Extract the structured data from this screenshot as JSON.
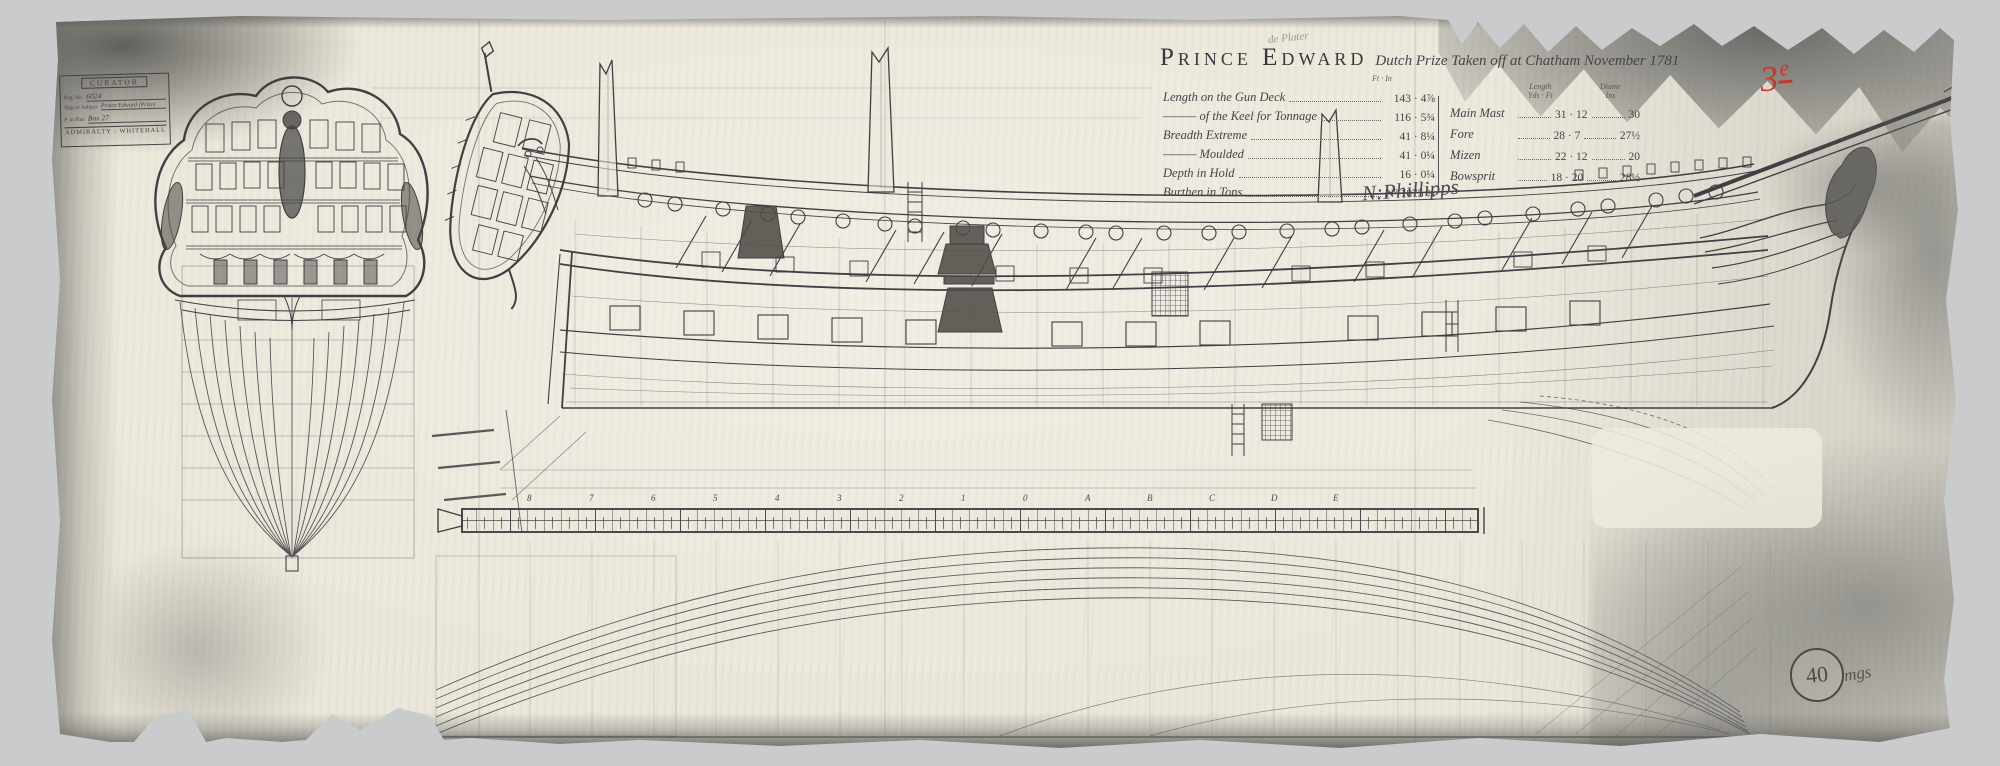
{
  "document": {
    "ship_name": "Prince Edward",
    "subtitle": "Dutch Prize Taken off at Chatham November 1781",
    "pencil_note": "de Plater",
    "signature": "N:Phillipps",
    "red_mark_digit": "3",
    "red_mark_sup": "e",
    "page_number": "40",
    "page_scribble": "mgs"
  },
  "stamp": {
    "header": "CURATOR",
    "reg_label": "Reg. No.",
    "reg_value": "6024",
    "subject_label": "Ship or Subject",
    "subject_value": "Prince Edward (Prize)",
    "plan_label": "P. in Plan",
    "plan_value": "Box 27",
    "footer": "ADMIRALTY : WHITEHALL"
  },
  "dimensions": {
    "col_header": "Ft · In",
    "rows": [
      {
        "label": "Length on the Gun Deck",
        "value": "143 · 4⅞"
      },
      {
        "label": "——— of the Keel for Tonnage",
        "value": "116 · 5¾"
      },
      {
        "label": "Breadth Extreme",
        "value": "41 · 8¼"
      },
      {
        "label": "——— Moulded",
        "value": "41 · 0¼"
      },
      {
        "label": "Depth in Hold",
        "value": "16 · 0¼"
      },
      {
        "label": "Burthen in Tons",
        "value": "Nº 1075 ¾"
      }
    ]
  },
  "masts": {
    "header_length": "Length",
    "header_length_units": "Yds · Ft",
    "header_diam": "Diamr",
    "header_diam_units": "Ins",
    "rows": [
      {
        "label": "Main Mast",
        "length": "31 · 12",
        "diam": "30"
      },
      {
        "label": "Fore",
        "length": "28 · 7",
        "diam": "27½"
      },
      {
        "label": "Mizen",
        "length": "22 · 12",
        "diam": "20"
      },
      {
        "label": "Bowsprit",
        "length": "18 · 20",
        "diam": "28½"
      }
    ]
  },
  "scale_stations": [
    "8",
    "7",
    "6",
    "5",
    "4",
    "3",
    "2",
    "1",
    "0",
    "A",
    "B",
    "C",
    "D",
    "E"
  ]
}
